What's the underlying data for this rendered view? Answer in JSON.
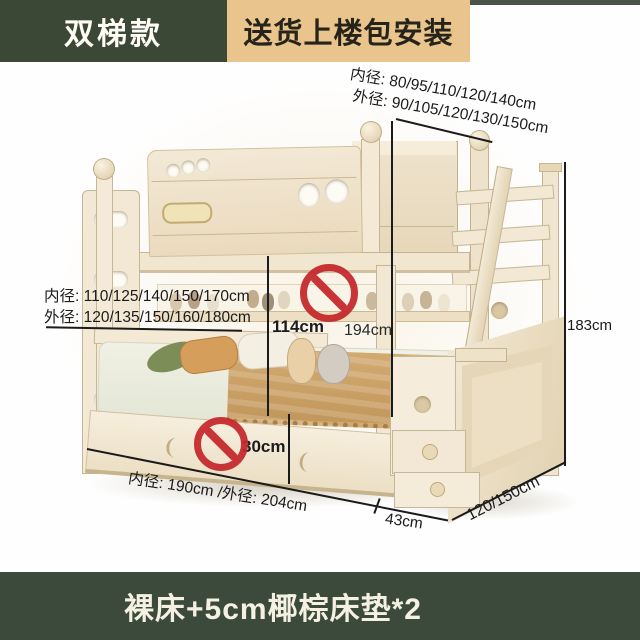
{
  "header": {
    "style_tag": "双梯款",
    "delivery_banner": "送货上楼包安装"
  },
  "dimensions": {
    "top_inner": "内径: 80/95/110/120/140cm",
    "top_outer": "外径: 90/105/120/130/150cm",
    "mid_inner": "内径: 110/125/140/150/170cm",
    "mid_outer": "外径: 120/135/150/160/180cm",
    "bunk_clearance_height": "114cm",
    "overall_height": "194cm",
    "stair_side_height": "183cm",
    "underbed_height": "30cm",
    "bed_length": "内径: 190cm /外径: 204cm",
    "stair_depth": "43cm",
    "bed_width": "120/150cm"
  },
  "footer": {
    "product_note": "裸床+5cm椰棕床垫*2"
  },
  "icons": {
    "no_photo_sign": "no-entry-icon"
  },
  "colors": {
    "header_dark_green": "#3c4836",
    "banner_tan": "#e9c48c",
    "banner_text": "#25231a",
    "footer_dark_green": "#3b4a3a",
    "footer_text": "#f4f1e2",
    "bed_cream": "#f3e9d6",
    "bed_shadow": "#dcc9a6",
    "blanket_tan": "#c99f63",
    "prohibition_red": "#c5272b",
    "dimension_line": "#1b1b1b"
  }
}
